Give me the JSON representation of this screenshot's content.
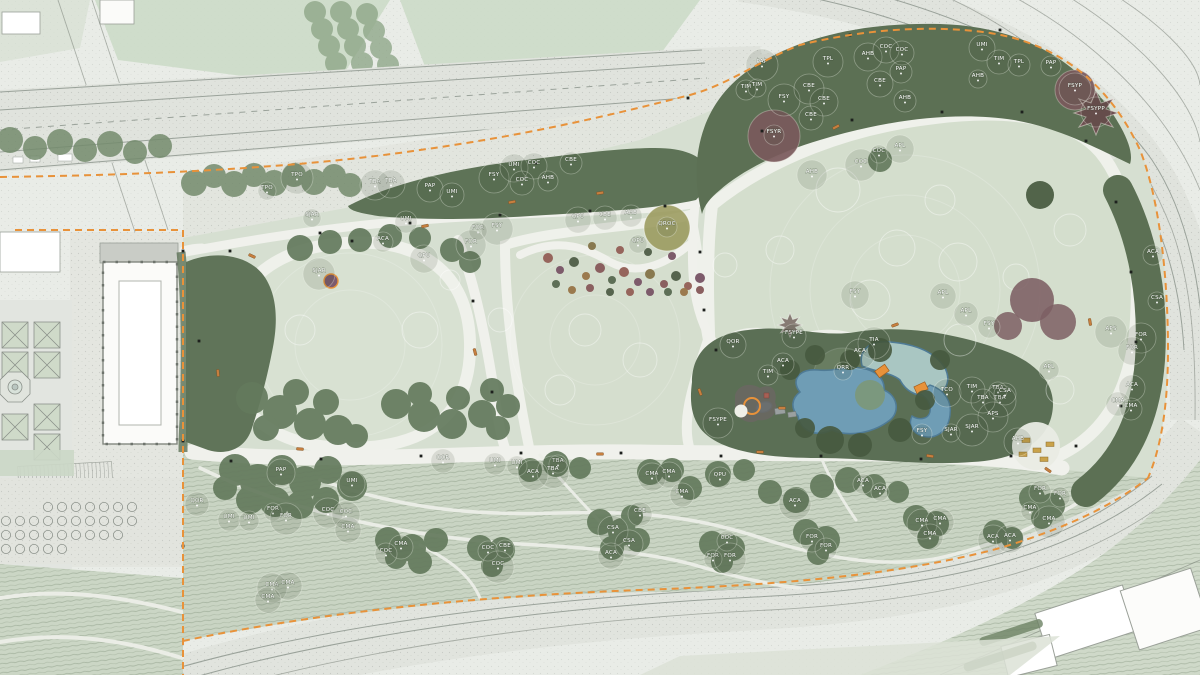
{
  "plan": {
    "type": "landscape-masterplan",
    "palette": {
      "paper": "#E9ECE7",
      "road": "#E0E3DD",
      "lawn": "#D6DFD1",
      "meadow": "#D4DECD",
      "slope": "#C9D4C3",
      "tree_belt": "#5E7357",
      "water": "#6F9DB5",
      "water_edge": "#4F7B96",
      "lagoon": "#A9C6C2",
      "boundary": "#E8923A",
      "bench": "#C77F3F",
      "purple_tree": "#7A5A5C",
      "golden_tree": "#99985A",
      "building": "#FBFBF9",
      "label_text": "#FFFFFF"
    },
    "tree_labels": [
      [
        "TPO",
        267,
        189
      ],
      [
        "TPO",
        297,
        176
      ],
      [
        "TBA",
        375,
        183
      ],
      [
        "TBA",
        391,
        182
      ],
      [
        "PAP",
        430,
        187
      ],
      [
        "UMI",
        452,
        193
      ],
      [
        "UMI",
        406,
        220
      ],
      [
        "ACA",
        383,
        240
      ],
      [
        "SJAR",
        312,
        216
      ],
      [
        "SJAR",
        319,
        272
      ],
      [
        "FSY",
        494,
        176
      ],
      [
        "UMI",
        514,
        166
      ],
      [
        "COC",
        534,
        164
      ],
      [
        "COC",
        522,
        181
      ],
      [
        "CBE",
        571,
        161
      ],
      [
        "AHB",
        548,
        179
      ],
      [
        "FOR",
        478,
        229
      ],
      [
        "FSY",
        497,
        227
      ],
      [
        "FOR",
        471,
        243
      ],
      [
        "QPU",
        424,
        257
      ],
      [
        "QPU",
        578,
        218
      ],
      [
        "CBE",
        605,
        216
      ],
      [
        "AHB",
        631,
        214
      ],
      [
        "QROC",
        667,
        225
      ],
      [
        "QPU",
        638,
        242
      ],
      [
        "PAP",
        762,
        63
      ],
      [
        "TPL",
        828,
        60
      ],
      [
        "AHB",
        868,
        55
      ],
      [
        "COC",
        886,
        48
      ],
      [
        "COC",
        902,
        51
      ],
      [
        "PAP",
        901,
        70
      ],
      [
        "TIM",
        746,
        88
      ],
      [
        "TIM",
        757,
        86
      ],
      [
        "FSY",
        784,
        98
      ],
      [
        "CBE",
        809,
        87
      ],
      [
        "CBE",
        824,
        100
      ],
      [
        "CBE",
        880,
        82
      ],
      [
        "CBE",
        811,
        116
      ],
      [
        "AHB",
        905,
        99
      ],
      [
        "FSYR",
        774,
        133
      ],
      [
        "COC",
        879,
        152
      ],
      [
        "COC",
        861,
        163
      ],
      [
        "AHB",
        812,
        173
      ],
      [
        "APL",
        900,
        147
      ],
      [
        "UMI",
        982,
        46
      ],
      [
        "TIM",
        999,
        60
      ],
      [
        "TPL",
        1019,
        63
      ],
      [
        "PAP",
        1051,
        64
      ],
      [
        "AHB",
        978,
        77
      ],
      [
        "FSYP",
        1075,
        87
      ],
      [
        "FSYPP",
        1096,
        110
      ],
      [
        "FSY",
        855,
        293
      ],
      [
        "APL",
        943,
        294
      ],
      [
        "APL",
        966,
        312
      ],
      [
        "FSY",
        989,
        325
      ],
      [
        "ACA",
        1153,
        253
      ],
      [
        "CSA",
        1157,
        299
      ],
      [
        "APS",
        1111,
        330
      ],
      [
        "FOR",
        1141,
        336
      ],
      [
        "FOR",
        1132,
        349
      ],
      [
        "ACA",
        1132,
        386
      ],
      [
        "CMA",
        1118,
        402
      ],
      [
        "CMA",
        1131,
        407
      ],
      [
        "APL",
        1049,
        368
      ],
      [
        "TBA",
        998,
        389
      ],
      [
        "TBA",
        1000,
        399
      ],
      [
        "APS",
        993,
        415
      ],
      [
        "AHB",
        1018,
        440
      ],
      [
        "QOR",
        733,
        343
      ],
      [
        "FSYPE",
        794,
        334
      ],
      [
        "ACA",
        783,
        362
      ],
      [
        "TIM",
        768,
        373
      ],
      [
        "QRR",
        843,
        369
      ],
      [
        "TIA",
        874,
        341
      ],
      [
        "ACA",
        860,
        352
      ],
      [
        "TCO",
        947,
        391
      ],
      [
        "TIM",
        972,
        388
      ],
      [
        "TBA",
        983,
        399
      ],
      [
        "CSA",
        1005,
        392
      ],
      [
        "FSY",
        922,
        432
      ],
      [
        "SJAR",
        951,
        431
      ],
      [
        "SJAR",
        972,
        428
      ],
      [
        "FSYPE",
        718,
        421
      ],
      [
        "PAP",
        281,
        471
      ],
      [
        "UMI",
        352,
        482
      ],
      [
        "QOR",
        197,
        502
      ],
      [
        "UMI",
        229,
        518
      ],
      [
        "UMI",
        249,
        519
      ],
      [
        "FOR",
        273,
        510
      ],
      [
        "FOR",
        286,
        517
      ],
      [
        "COC",
        328,
        511
      ],
      [
        "COC",
        346,
        513
      ],
      [
        "CMA",
        348,
        528
      ],
      [
        "CMA",
        401,
        545
      ],
      [
        "COC",
        386,
        552
      ],
      [
        "COC",
        488,
        549
      ],
      [
        "CBE",
        505,
        547
      ],
      [
        "COC",
        498,
        565
      ],
      [
        "CMA",
        272,
        586
      ],
      [
        "CMA",
        288,
        584
      ],
      [
        "CMA",
        268,
        598
      ],
      [
        "QOR",
        443,
        459
      ],
      [
        "UMI",
        495,
        462
      ],
      [
        "UMI",
        517,
        464
      ],
      [
        "TBA",
        558,
        462
      ],
      [
        "TBA",
        553,
        470
      ],
      [
        "ACA",
        533,
        473
      ],
      [
        "CMA",
        652,
        475
      ],
      [
        "CMA",
        669,
        473
      ],
      [
        "CMA",
        682,
        493
      ],
      [
        "QPU",
        720,
        476
      ],
      [
        "ACA",
        863,
        482
      ],
      [
        "ACA",
        880,
        490
      ],
      [
        "ACA",
        795,
        502
      ],
      [
        "CMA",
        922,
        522
      ],
      [
        "CMA",
        940,
        520
      ],
      [
        "CMA",
        930,
        535
      ],
      [
        "FOR",
        812,
        538
      ],
      [
        "FOR",
        826,
        547
      ],
      [
        "COC",
        727,
        539
      ],
      [
        "FOR",
        713,
        557
      ],
      [
        "FOR",
        730,
        557
      ],
      [
        "CSA",
        613,
        529
      ],
      [
        "CSA",
        629,
        542
      ],
      [
        "ACA",
        611,
        554
      ],
      [
        "CBE",
        640,
        512
      ],
      [
        "FOR",
        1040,
        490
      ],
      [
        "FOR",
        1060,
        495
      ],
      [
        "CMA",
        1030,
        509
      ],
      [
        "CMA",
        1049,
        520
      ],
      [
        "ACA",
        993,
        538
      ],
      [
        "ACA",
        1010,
        537
      ]
    ],
    "benches": [
      [
        425,
        226,
        -12
      ],
      [
        512,
        202,
        -10
      ],
      [
        600,
        193,
        -8
      ],
      [
        836,
        127,
        -28
      ],
      [
        252,
        256,
        25
      ],
      [
        218,
        373,
        85
      ],
      [
        475,
        352,
        75
      ],
      [
        300,
        449,
        5
      ],
      [
        600,
        454,
        0
      ],
      [
        760,
        452,
        0
      ],
      [
        930,
        456,
        8
      ],
      [
        1048,
        470,
        35
      ],
      [
        1090,
        322,
        80
      ],
      [
        700,
        392,
        70
      ],
      [
        782,
        408,
        0
      ],
      [
        895,
        325,
        -20
      ]
    ],
    "lamps": [
      [
        230,
        251
      ],
      [
        320,
        233
      ],
      [
        410,
        223
      ],
      [
        500,
        215
      ],
      [
        590,
        211
      ],
      [
        665,
        206
      ],
      [
        700,
        252
      ],
      [
        704,
        310
      ],
      [
        716,
        350
      ],
      [
        762,
        131
      ],
      [
        852,
        120
      ],
      [
        942,
        112
      ],
      [
        1022,
        112
      ],
      [
        1086,
        141
      ],
      [
        1116,
        202
      ],
      [
        1131,
        272
      ],
      [
        1136,
        342
      ],
      [
        1121,
        406
      ],
      [
        1076,
        446
      ],
      [
        1011,
        456
      ],
      [
        921,
        459
      ],
      [
        821,
        456
      ],
      [
        721,
        456
      ],
      [
        621,
        453
      ],
      [
        521,
        453
      ],
      [
        421,
        456
      ],
      [
        321,
        459
      ],
      [
        231,
        461
      ],
      [
        199,
        341
      ],
      [
        473,
        301
      ],
      [
        492,
        392
      ],
      [
        352,
        241
      ],
      [
        183,
        251
      ],
      [
        183,
        441
      ],
      [
        183,
        546
      ],
      [
        536,
        163
      ],
      [
        688,
        98
      ],
      [
        850,
        35
      ],
      [
        1000,
        30
      ]
    ]
  }
}
